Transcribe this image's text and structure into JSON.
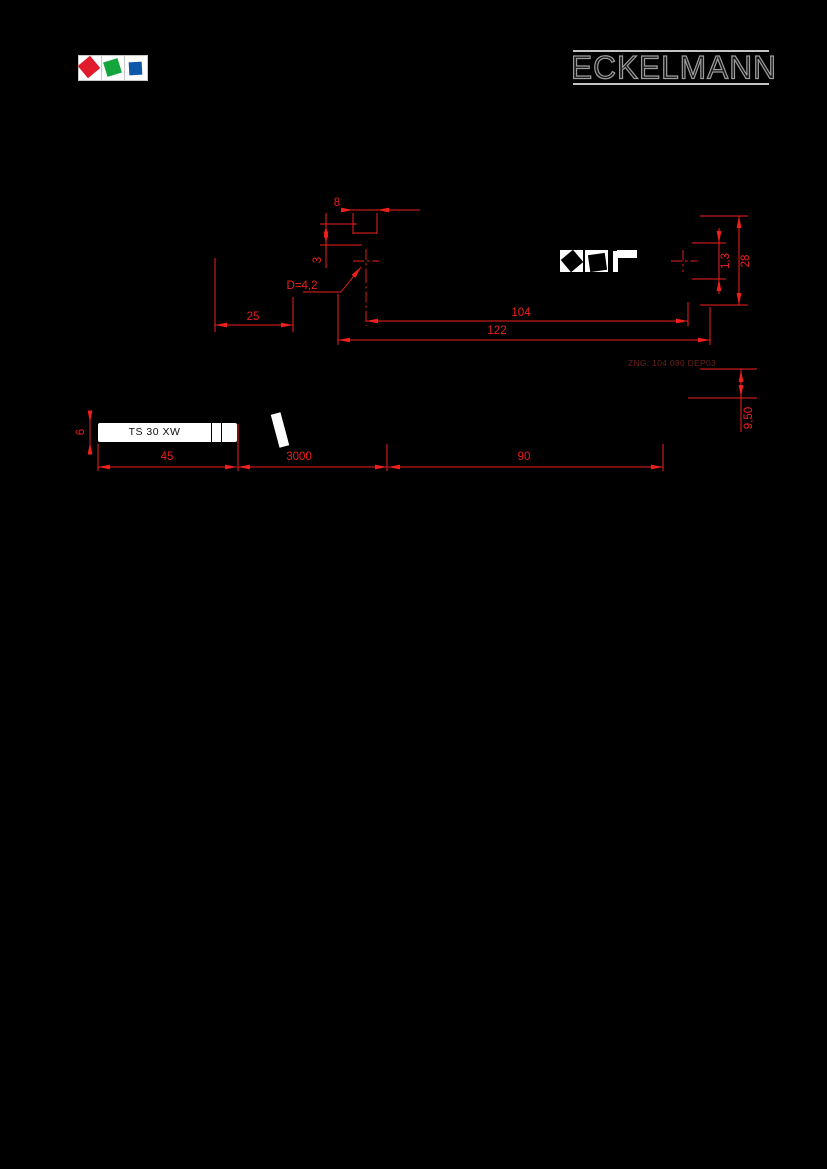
{
  "colors": {
    "accent": "#ee1f1c",
    "note_text": "#6b211b",
    "wordmark_stroke": "#9b9b9b",
    "logo_red": "#e01b2b",
    "logo_green": "#14a53c",
    "logo_blue": "#0f57a8"
  },
  "header": {
    "wordmark": "ECKELMANN"
  },
  "drawing": {
    "note_ref": "ZNG: 104 080 DEP03",
    "label_text": "TS 30 XW",
    "dims": {
      "d8": "8",
      "d3": "3",
      "d25": "25",
      "d104": "104",
      "d122": "122",
      "hole": "D=4,2",
      "d13": "1,3",
      "d28": "28",
      "d6": "6",
      "d45": "45",
      "d3000": "3000",
      "d90": "90",
      "d950": "9,50"
    }
  }
}
